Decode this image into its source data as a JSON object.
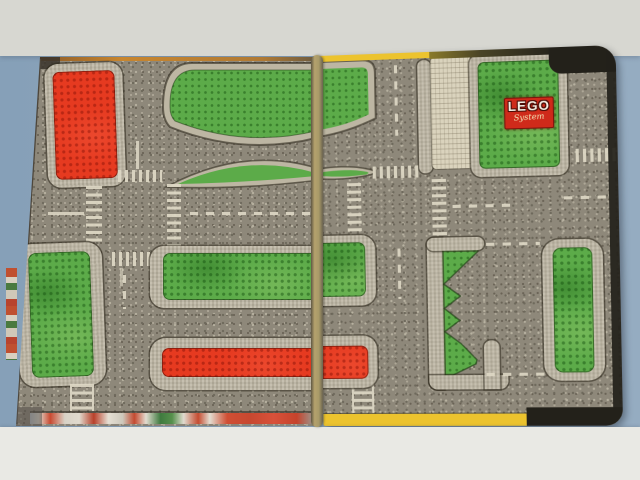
{
  "scene": {
    "title": "LEGO System town-plan folding play board",
    "setting": "two-panel cardboard road mat photographed on a blue-gray backdrop"
  },
  "logo": {
    "brand": "LEGO",
    "subtitle": "System"
  },
  "colors": {
    "backdrop_left": "#86a0b8",
    "backdrop_right": "#95acc1",
    "backdrop_top": "#d7d7d1",
    "backdrop_bottom": "#e9e9e4",
    "road": "#8e887a",
    "road_speck_dark": "#6e695c",
    "road_speck_light": "#b7b1a0",
    "curb": "#bdb6a3",
    "grass": "#5cab49",
    "plate_red": "#e63a20",
    "plate_cream": "#dad3bd",
    "marking": "#ded8c5",
    "seam": "#a89a68",
    "edge_yellow": "#ecc32e",
    "edge_dark": "#23211a",
    "edge_orange": "#c8862f",
    "logo_red": "#cf2a1a",
    "logo_text": "#f4efe4"
  }
}
